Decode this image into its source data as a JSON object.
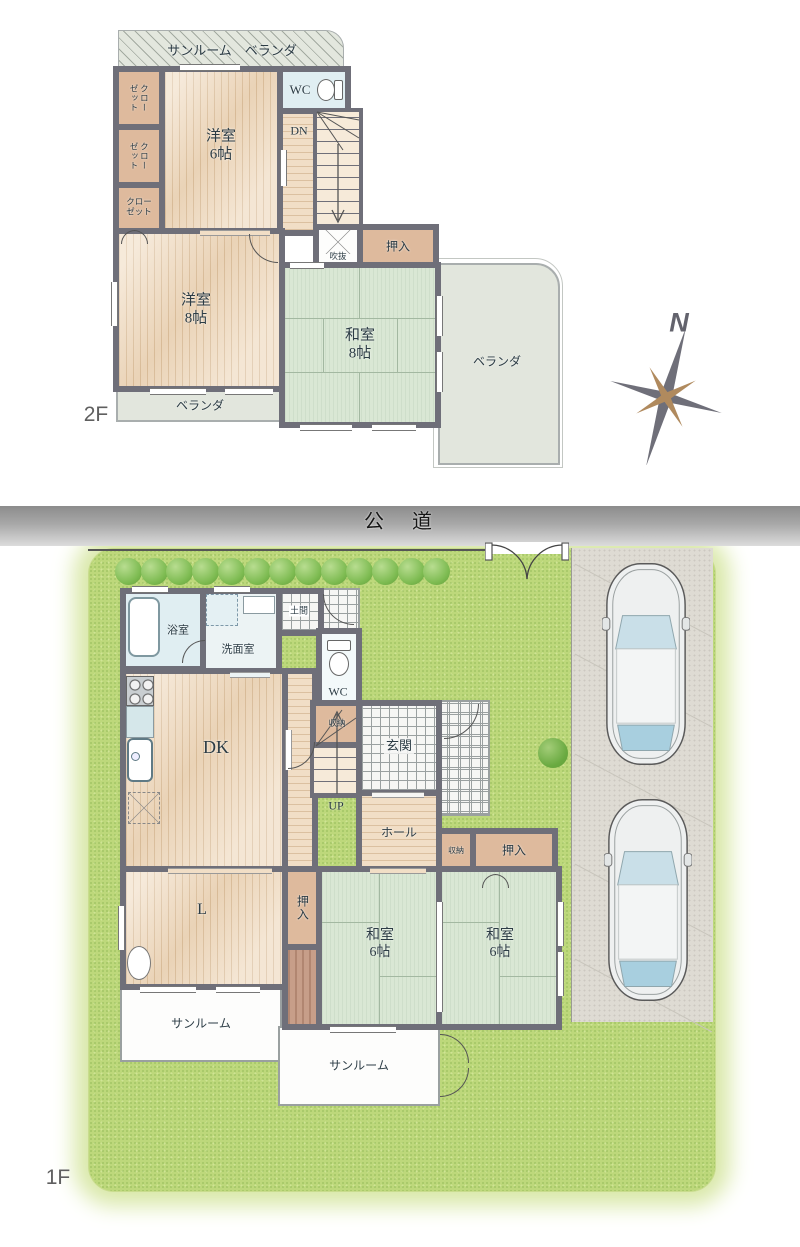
{
  "meta": {
    "floor2_label": "2F",
    "floor1_label": "1F"
  },
  "compass": {
    "north": "N"
  },
  "floor2": {
    "sunroom_veranda": "サンルーム　ベランダ",
    "closet_vertical_1": "クローゼット",
    "closet_vertical_2": "クローゼット",
    "closet_bottom": "クロー\nゼット",
    "western_room_6": "洋室\n6帖",
    "wc": "WC",
    "dn": "DN",
    "void": "吹抜",
    "oshiire": "押入",
    "western_room_8": "洋室\n8帖",
    "japanese_room_8": "和室\n8帖",
    "veranda_south": "ベランダ",
    "veranda_east": "ベランダ"
  },
  "floor1": {
    "road": "公　道",
    "bathroom": "浴室",
    "washroom": "洗面室",
    "doma": "土間",
    "wc": "WC",
    "dk": "DK",
    "storage_stair": "収納",
    "entrance": "玄関",
    "up": "UP",
    "hall": "ホール",
    "storage_small": "収納",
    "oshiire_north": "押入",
    "living": "L",
    "oshiire_west": "押入",
    "japanese_room_6_a": "和室\n6帖",
    "japanese_room_6_b": "和室\n6帖",
    "sunroom_west": "サンルーム",
    "sunroom_south": "サンルーム"
  },
  "colors": {
    "wall": "#6f6f79",
    "wood": "#f1dec6",
    "tatami": "#d9e7d4",
    "closet_tan": "#deba9d",
    "lawn": "#bdd87b",
    "road": "#9a9a9a",
    "veranda": "#e2e6dd",
    "deck": "#c79e89",
    "compass_brown": "#b08a5e"
  }
}
